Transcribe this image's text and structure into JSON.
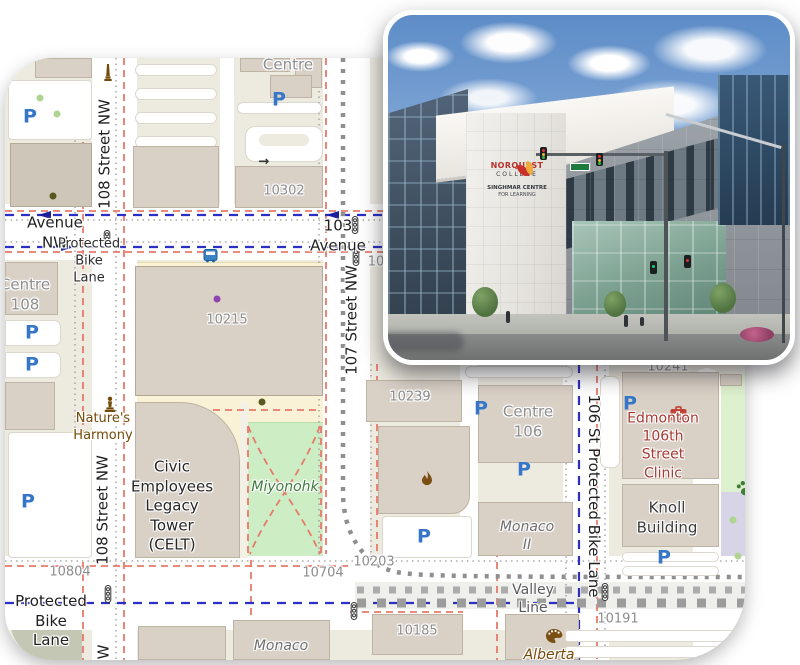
{
  "photo": {
    "alt": "NorQuest College Singhmar Centre for Learning building, street corner with traffic lights",
    "sign_line1": "NORQUEST",
    "sign_line2": "COLLEGE",
    "sign_line3": "SINGHMAR CENTRE",
    "sign_line4": "FOR LEARNING"
  },
  "colors": {
    "road": "#FFFFFF",
    "block_beige": "#EDEAE0",
    "building": "#D9D0C6",
    "building_outline": "#BFB3A4",
    "retail_cream": "#FAF2D7",
    "park_green": "#CDEDC4",
    "dog_park_green": "#DDF1CE",
    "lavender_area": "#D8D4E8",
    "cycleway_blue": "#2B2FC4",
    "footpath_salmon": "#E8796A",
    "rail_construction_gray": "#8F8F8F",
    "parking_blue": "#3576C8",
    "clinic_red": "#A63A32",
    "park_label_green": "#3E7C3E",
    "poi_brown": "#734A08"
  },
  "map": {
    "labels": [
      {
        "name": "street-avenue-nw",
        "text": "Avenue NW",
        "x": 50,
        "y": 175,
        "style": "st"
      },
      {
        "name": "street-103-avenue",
        "text": "103 Avenue",
        "x": 333,
        "y": 178,
        "style": "st"
      },
      {
        "name": "street-protected-bike-lane",
        "text": "Protected Bike Lane",
        "x": 84,
        "y": 204,
        "style": "stsm"
      },
      {
        "name": "street-108-nw-top",
        "text": "108 Street NW",
        "x": 100,
        "y": 96,
        "style": "st",
        "rot": "up"
      },
      {
        "name": "street-108-nw-mid",
        "text": "108 Street NW",
        "x": 98,
        "y": 452,
        "style": "st",
        "rot": "up"
      },
      {
        "name": "street-108-nw-partial",
        "text": "W",
        "x": 99,
        "y": 594,
        "style": "st",
        "rot": "up"
      },
      {
        "name": "street-107-nw",
        "text": "107 Street NW",
        "x": 347,
        "y": 262,
        "style": "st",
        "rot": "up"
      },
      {
        "name": "street-106-st-pbl",
        "text": "106 St Protected Bike Lane",
        "x": 588,
        "y": 438,
        "style": "st",
        "rot": "down"
      },
      {
        "name": "street-protected-bike-lane-s",
        "text": "Protected Bike Lane",
        "x": 46,
        "y": 563,
        "style": "st"
      },
      {
        "name": "valley-line",
        "text": "Valley Line",
        "x": 528,
        "y": 541,
        "style": "valley"
      },
      {
        "name": "bld-centre-top",
        "text": "Centre",
        "x": 283,
        "y": 7,
        "style": "numlg"
      },
      {
        "name": "bld-10302",
        "text": "10302",
        "x": 279,
        "y": 134,
        "style": "num"
      },
      {
        "name": "bld-10215",
        "text": "10215",
        "x": 222,
        "y": 263,
        "style": "num"
      },
      {
        "name": "bld-centre-108",
        "text": "Centre\n108",
        "x": 20,
        "y": 237,
        "style": "numlg"
      },
      {
        "name": "bld-10-partial",
        "text": "10",
        "x": 371,
        "y": 205,
        "style": "num"
      },
      {
        "name": "bld-10239",
        "text": "10239",
        "x": 405,
        "y": 340,
        "style": "num"
      },
      {
        "name": "bld-centre-106",
        "text": "Centre\n106",
        "x": 523,
        "y": 364,
        "style": "numlg"
      },
      {
        "name": "bld-10241",
        "text": "10241",
        "x": 663,
        "y": 310,
        "style": "num"
      },
      {
        "name": "bld-10804",
        "text": "10804",
        "x": 65,
        "y": 515,
        "style": "num"
      },
      {
        "name": "bld-10704",
        "text": "10704",
        "x": 318,
        "y": 516,
        "style": "num"
      },
      {
        "name": "bld-10203",
        "text": "10203",
        "x": 369,
        "y": 505,
        "style": "num"
      },
      {
        "name": "bld-10185",
        "text": "10185",
        "x": 412,
        "y": 574,
        "style": "num"
      },
      {
        "name": "bld-10191",
        "text": "10191",
        "x": 613,
        "y": 562,
        "style": "num"
      },
      {
        "name": "bld-knoll",
        "text": "Knoll\nBuilding",
        "x": 662,
        "y": 460,
        "style": "place"
      },
      {
        "name": "bld-monaco-ii",
        "text": "Monaco\nII",
        "x": 522,
        "y": 478,
        "style": "grayi"
      },
      {
        "name": "bld-monaco",
        "text": "Monaco",
        "x": 276,
        "y": 588,
        "style": "grayi"
      },
      {
        "name": "poi-alberta",
        "text": "Alberta",
        "x": 544,
        "y": 597,
        "style": "browni"
      },
      {
        "name": "park-miyonohk",
        "text": "Miyonohk",
        "x": 280,
        "y": 429,
        "style": "green"
      },
      {
        "name": "poi-natures-harmony",
        "text": "Nature's\nHarmony",
        "x": 98,
        "y": 370,
        "style": "brown"
      },
      {
        "name": "poi-edmonton-clinic",
        "text": "Edmonton\n106th Street\nClinic",
        "x": 658,
        "y": 388,
        "style": "red"
      },
      {
        "name": "bld-celt",
        "text": "Civic\nEmployees\nLegacy\nTower\n(CELT)",
        "x": 167,
        "y": 448,
        "style": "placelg"
      }
    ],
    "icons": [
      {
        "type": "parking",
        "name": "parking-icon",
        "x": 25,
        "y": 59
      },
      {
        "type": "parking",
        "name": "parking-icon",
        "x": 274,
        "y": 42
      },
      {
        "type": "parking",
        "name": "parking-icon",
        "x": 27,
        "y": 275
      },
      {
        "type": "parking",
        "name": "parking-icon",
        "x": 27,
        "y": 307
      },
      {
        "type": "parking",
        "name": "parking-icon",
        "x": 23,
        "y": 444
      },
      {
        "type": "parking",
        "name": "parking-icon",
        "x": 476,
        "y": 351
      },
      {
        "type": "parking",
        "name": "parking-icon",
        "x": 519,
        "y": 412
      },
      {
        "type": "parking",
        "name": "parking-icon",
        "x": 419,
        "y": 479
      },
      {
        "type": "parking",
        "name": "parking-icon",
        "x": 625,
        "y": 346
      },
      {
        "type": "parking",
        "name": "parking-icon",
        "x": 659,
        "y": 500
      },
      {
        "type": "signal",
        "name": "traffic-signal-icon",
        "x": 97,
        "y": 172
      },
      {
        "type": "signal",
        "name": "traffic-signal-icon",
        "x": 345,
        "y": 158
      },
      {
        "type": "signal",
        "name": "traffic-signal-icon",
        "x": 346,
        "y": 190
      },
      {
        "type": "signal",
        "name": "traffic-signal-icon",
        "x": 98,
        "y": 527
      },
      {
        "type": "signal",
        "name": "traffic-signal-icon",
        "x": 344,
        "y": 544
      },
      {
        "type": "signal",
        "name": "traffic-signal-icon",
        "x": 595,
        "y": 525
      },
      {
        "type": "bus",
        "name": "bus-stop-icon",
        "x": 198,
        "y": 190
      },
      {
        "type": "obelisk",
        "name": "monument-icon",
        "x": 98,
        "y": 6
      },
      {
        "type": "fountain",
        "name": "artwork-monument-icon",
        "x": 98,
        "y": 338
      },
      {
        "type": "flame",
        "name": "flame-icon",
        "x": 414,
        "y": 413
      },
      {
        "type": "medical",
        "name": "clinic-cross-icon",
        "x": 665,
        "y": 348
      },
      {
        "type": "palette",
        "name": "art-gallery-icon",
        "x": 541,
        "y": 571
      },
      {
        "type": "paw",
        "name": "paw-icon",
        "x": 731,
        "y": 422
      },
      {
        "type": "arrow-right",
        "name": "driveway-arrow-icon",
        "x": 259,
        "y": 104
      },
      {
        "type": "dot",
        "name": "artwork-dot",
        "color": "#8E44AD",
        "x": 212,
        "y": 241
      },
      {
        "type": "dot",
        "name": "tree-dot-dark",
        "color": "#57571F",
        "x": 257,
        "y": 344
      },
      {
        "type": "dot",
        "name": "tree-dot-dark",
        "color": "#57571F",
        "x": 48,
        "y": 138
      },
      {
        "type": "dot",
        "name": "tree-dot",
        "color": "#AFD48F",
        "x": 35,
        "y": 40
      },
      {
        "type": "dot",
        "name": "tree-dot",
        "color": "#AFD48F",
        "x": 52,
        "y": 56
      },
      {
        "type": "dot",
        "name": "tree-dot",
        "color": "#AFD48F",
        "x": 728,
        "y": 462
      },
      {
        "type": "dot",
        "name": "tree-dot",
        "color": "#AFD48F",
        "x": 733,
        "y": 498
      }
    ]
  }
}
